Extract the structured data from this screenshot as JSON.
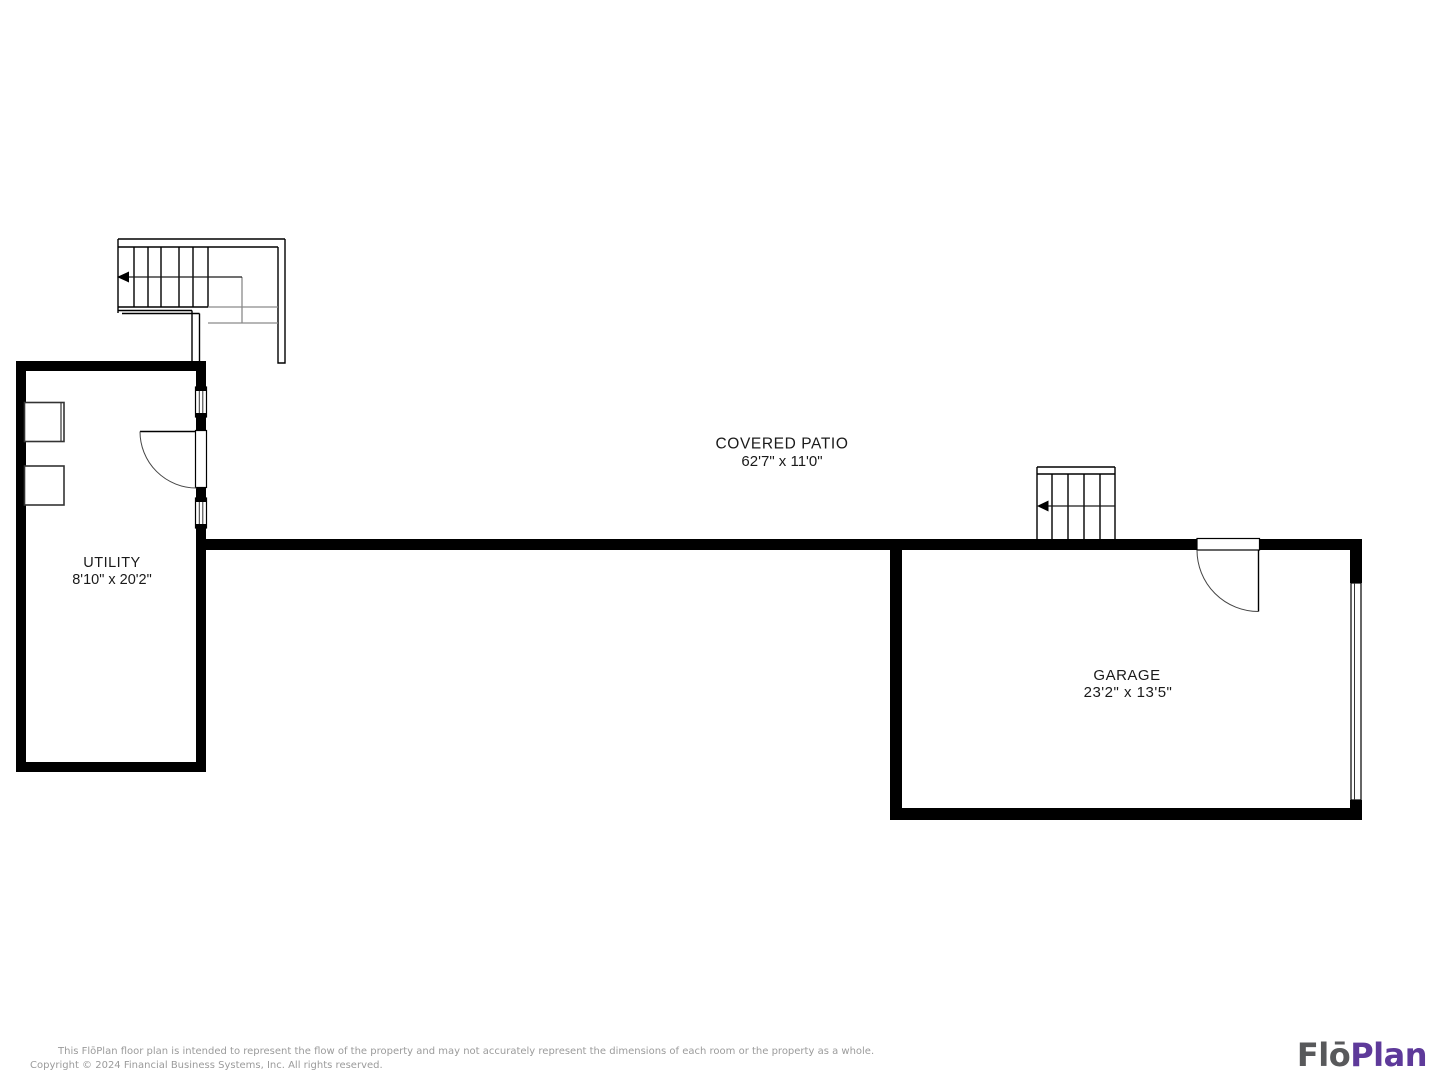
{
  "page": {
    "background": "#ffffff",
    "width": 1440,
    "height": 1080
  },
  "floor_plan": {
    "rooms": [
      {
        "id": "utility",
        "label": "UTILITY",
        "dimensions": "8'10\" x 20'2\""
      },
      {
        "id": "covered-patio",
        "label": "COVERED PATIO",
        "dimensions": "62'7\" x 11'0\""
      },
      {
        "id": "garage",
        "label": "GARAGE",
        "dimensions": "23'2\" x 13'5\""
      }
    ],
    "features": [
      {
        "id": "staircase-upper-left",
        "type": "staircase",
        "arrow_direction": "left"
      },
      {
        "id": "staircase-garage",
        "type": "staircase",
        "arrow_direction": "left"
      },
      {
        "id": "utility-door",
        "type": "swing-door"
      },
      {
        "id": "utility-window-upper",
        "type": "window"
      },
      {
        "id": "utility-window-lower",
        "type": "window"
      },
      {
        "id": "washer-dryer-squares",
        "type": "appliances"
      },
      {
        "id": "garage-entry-door",
        "type": "swing-door"
      },
      {
        "id": "garage-vehicle-door",
        "type": "garage-door"
      }
    ],
    "colors": {
      "wall": "#000000",
      "line": "#1a1a1a",
      "secondary_line": "#8a8a8a",
      "label_text": "#1a1a1a"
    }
  },
  "footer": {
    "disclaimer": "This FlōPlan floor plan is intended to represent the flow of the property and may not accurately represent the dimensions of each room or the property as a whole.",
    "copyright": "Copyright © 2024 Financial Business Systems, Inc. All rights reserved.",
    "text_color": "#9b9b9b"
  },
  "logo": {
    "part1": "Flō",
    "part2": "Plan",
    "part1_color": "#58595B",
    "part2_color": "#5E3A9A"
  }
}
